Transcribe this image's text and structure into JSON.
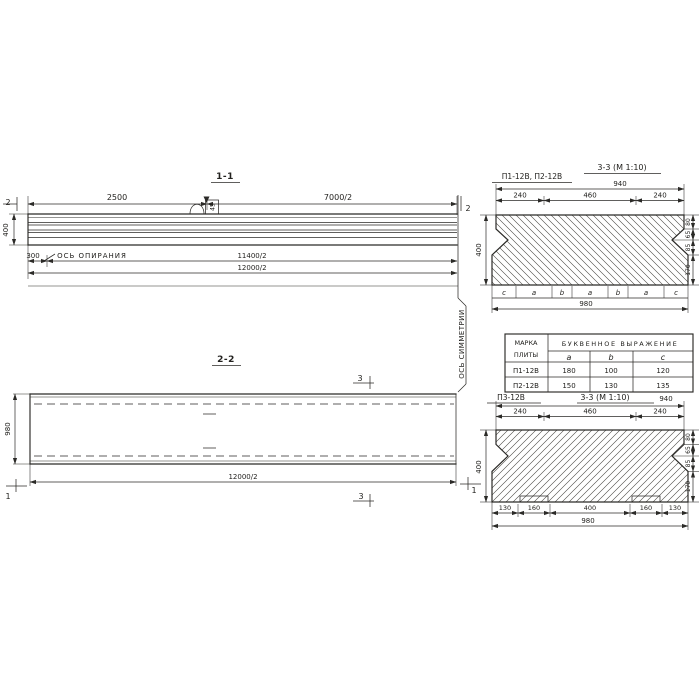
{
  "drawing": {
    "s11": {
      "title": "1-1",
      "d2500": "2500",
      "d7000": "7000/2",
      "d11400": "11400/2",
      "d12000": "12000/2",
      "d400": "400",
      "d300": "300",
      "marker2": "2",
      "bearing_axis": "ОСЬ ОПИРАНИЯ",
      "loop_label": "45"
    },
    "sym_axis": "ОСЬ СИММЕТРИИ",
    "s22": {
      "title": "2-2",
      "d980": "980",
      "d12000": "12000/2",
      "marker3": "3",
      "marker1": "1"
    },
    "s33a": {
      "label": "П1-12В, П2-12В",
      "title": "3-3 (М 1:10)",
      "d940": "940",
      "d240l": "240",
      "d460": "460",
      "d240r": "240",
      "d400": "400",
      "d980": "980",
      "letters": [
        "c",
        "a",
        "b",
        "a",
        "b",
        "a",
        "c"
      ],
      "right_dims": [
        "80",
        "65",
        "85",
        "170"
      ]
    },
    "table": {
      "mark1": "МАРКА",
      "mark2": "ПЛИТЫ",
      "expr": "БУКВЕННОЕ ВЫРАЖЕНИЕ",
      "cols": [
        "a",
        "b",
        "c"
      ],
      "rows": [
        {
          "mark": "П1-12В",
          "a": "180",
          "b": "100",
          "c": "120"
        },
        {
          "mark": "П2-12В",
          "a": "150",
          "b": "130",
          "c": "135"
        }
      ]
    },
    "s33b": {
      "label": "П3-12В",
      "title": "3-3 (М 1:10)",
      "d940": "940",
      "d240l": "240",
      "d460": "460",
      "d240r": "240",
      "d400": "400",
      "d980": "980",
      "bottom_dims": [
        "130",
        "160",
        "400",
        "160",
        "130"
      ],
      "right_dims": [
        "80",
        "65",
        "85",
        "170"
      ]
    }
  }
}
